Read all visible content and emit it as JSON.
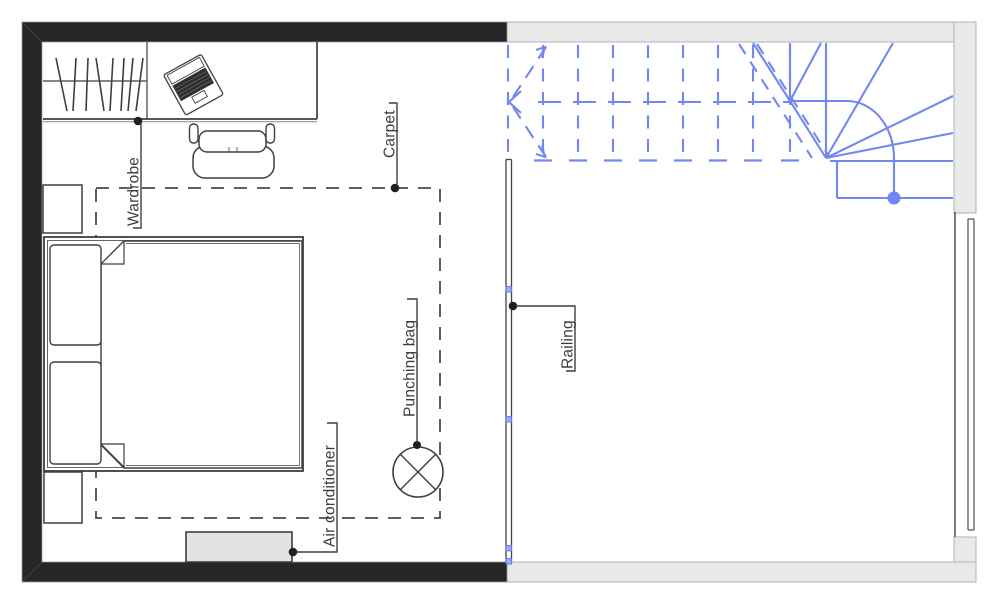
{
  "labels": {
    "wardrobe": "Wardrobe",
    "carpet": "Carpet",
    "punching_bag": "Punching bag",
    "air_conditioner": "Air conditioner",
    "railing": "Railing"
  },
  "colors": {
    "wall_black": "#262626",
    "wall_gray_fill": "#e9e9e9",
    "wall_gray_outline": "#b3b3b3",
    "stair_blue": "#7288ee",
    "stair_dot_blue": "#6f87f3",
    "railing_marker_blue": "#9dacf5",
    "furniture_line": "#3f3f3f",
    "label_text": "#3d3d3d",
    "air_conditioner_fill": "#e2e2e2"
  },
  "symbols": [
    "wardrobe",
    "desk",
    "laptop",
    "office-chair",
    "double-bed",
    "pillow",
    "blanket",
    "nightstand",
    "carpet-outline",
    "punching-bag",
    "air-conditioner",
    "railing",
    "winder-staircase",
    "stair-direction-arrow",
    "window"
  ]
}
